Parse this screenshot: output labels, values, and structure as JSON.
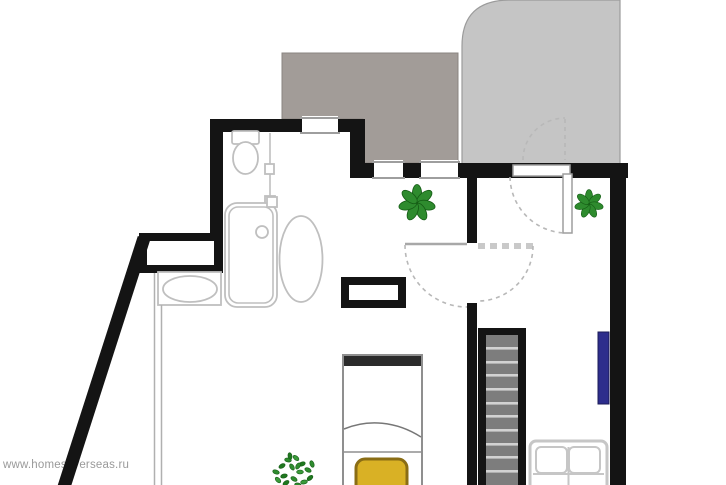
{
  "watermark": {
    "text": "www.homesoverseas.ru"
  },
  "plan": {
    "type": "apartment-floor-plan",
    "colors": {
      "wall": "#141414",
      "terrace_fill": "#a29c98",
      "balcony_fill": "#c5c5c5",
      "fixture_outline": "#bfbfbf",
      "door_dash": "#b8b8b8",
      "stair_tread": "#7d7d7d",
      "stair_line": "#d2d2d2",
      "radiator": "#2d2d8c",
      "pillow_fill": "#d9b125",
      "pillow_border": "#8a6d15",
      "plant_green": "#2e8b2e",
      "plant_dark": "#155c15",
      "bed_outline": "#8f8f8f",
      "headboard": "#2b2b2b",
      "sofa_outline": "#c6c6c6",
      "watermark_gray": "#9a9a9a"
    },
    "icons": {
      "pinwheel-plant-icon": "rosette of 7 green petals",
      "bush-plant-icon": "cluster of small green leaves",
      "toilet-icon": "tank rectangle with oval bowl",
      "bathtub-icon": "vertical rounded rectangle with drain circle",
      "washbasin-icon": "oval basin inside rectangle",
      "door-swing-icon": "dashed quarter-circle arc",
      "window-icon": "white band across wall with thin gray lines",
      "stairs-icon": "vertical flight with gray treads and black stringers",
      "radiator-icon": "navy blue vertical bar",
      "bed-icon": "bed with black headboard and yellow pillow",
      "sofa-icon": "two-seat sofa with four cushions",
      "coffee-table-icon": "thick black-bordered rectangle"
    },
    "elements": [
      "dark-gray-terrace",
      "light-gray-covered-balcony",
      "bathroom-toilet",
      "bathroom-bathtub",
      "bathroom-washbasin",
      "wall-niche-shaft",
      "diagonal-exterior-wall",
      "double-interior-door",
      "balcony-door",
      "staircase",
      "radiator",
      "bed-with-yellow-pillow",
      "black-coffee-table",
      "oval-table",
      "two-seat-sofa",
      "plant-1",
      "plant-2",
      "plant-3"
    ],
    "stairs_visible_steps": 11,
    "windows_count": 4
  }
}
